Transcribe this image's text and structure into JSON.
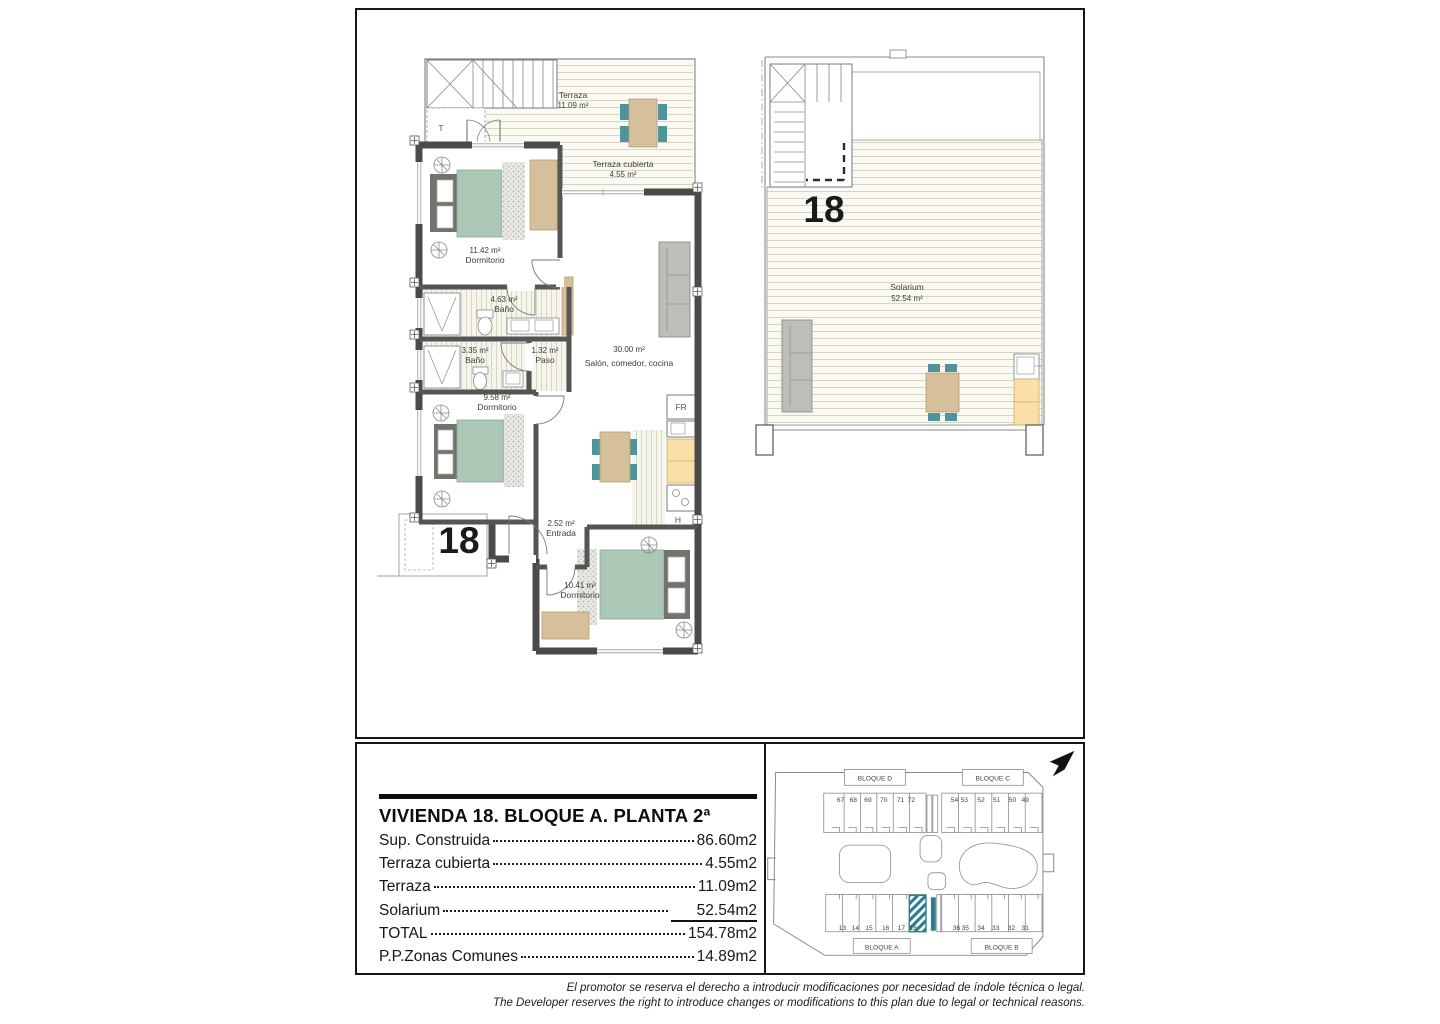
{
  "title_block": {
    "title": "VIVIENDA 18. BLOQUE A. PLANTA 2ª",
    "rows": [
      {
        "label": "Sup. Construida",
        "value": "86.60m2"
      },
      {
        "label": "Terraza cubierta",
        "value": "4.55m2"
      },
      {
        "label": "Terraza",
        "value": "11.09m2"
      },
      {
        "label": "Solarium",
        "value": "52.54m2"
      },
      {
        "label": "TOTAL",
        "value": "154.78m2"
      },
      {
        "label": "P.P.Zonas Comunes",
        "value": "14.89m2"
      }
    ]
  },
  "disclaimer": {
    "es": "El promotor se reserva el derecho a introducir modificaciones por necesidad de índole técnica o legal.",
    "en": "The Developer reserves the right to introduce changes or modifications to this plan due to legal or technical reasons."
  },
  "floor_plan": {
    "unit_number": "18",
    "rooms": [
      {
        "name": "Terraza",
        "area": "11.09 m²"
      },
      {
        "name": "Terraza cubierta",
        "area": "4.55 m²"
      },
      {
        "name": "Dormitorio",
        "area": "11.42 m²"
      },
      {
        "name": "Baño",
        "area": "4.63 m²"
      },
      {
        "name": "Baño",
        "area": "3.35 m²"
      },
      {
        "name": "Paso",
        "area": "1.32 m²"
      },
      {
        "name": "Salón, comedor, cocina",
        "area": "30.00 m²"
      },
      {
        "name": "Dormitorio",
        "area": "9.58 m²"
      },
      {
        "name": "Entrada",
        "area": "2.52 m²"
      },
      {
        "name": "Dormitorio",
        "area": "10.41 m²"
      }
    ],
    "labels": {
      "fridge": "FR",
      "hob": "H",
      "laundry": "T"
    }
  },
  "solarium_plan": {
    "unit_number": "18",
    "room_name": "Solarium",
    "room_area": "52.54 m²"
  },
  "site_plan": {
    "blocks": [
      {
        "name": "BLOQUE D",
        "units": [
          "67",
          "68",
          "69",
          "70",
          "71",
          "72"
        ]
      },
      {
        "name": "BLOQUE C",
        "units": [
          "54",
          "53",
          "52",
          "51",
          "50",
          "49"
        ]
      },
      {
        "name": "BLOQUE A",
        "units": [
          "13",
          "14",
          "15",
          "16",
          "17",
          "18"
        ]
      },
      {
        "name": "BLOQUE B",
        "units": [
          "36",
          "35",
          "34",
          "33",
          "32",
          "31"
        ]
      }
    ],
    "highlighted_unit": "18"
  },
  "colors": {
    "bed_teal": "#abc8b6",
    "chair_teal": "#4f949b",
    "furniture_tan": "#d6bf9b",
    "counter_yellow": "#f8e0a6",
    "sofa_gray": "#bdbdba",
    "wall_gray": "#4a4a4a",
    "deck_cream": "#fbfaf2",
    "highlight_teal": "#2a7f8f"
  }
}
